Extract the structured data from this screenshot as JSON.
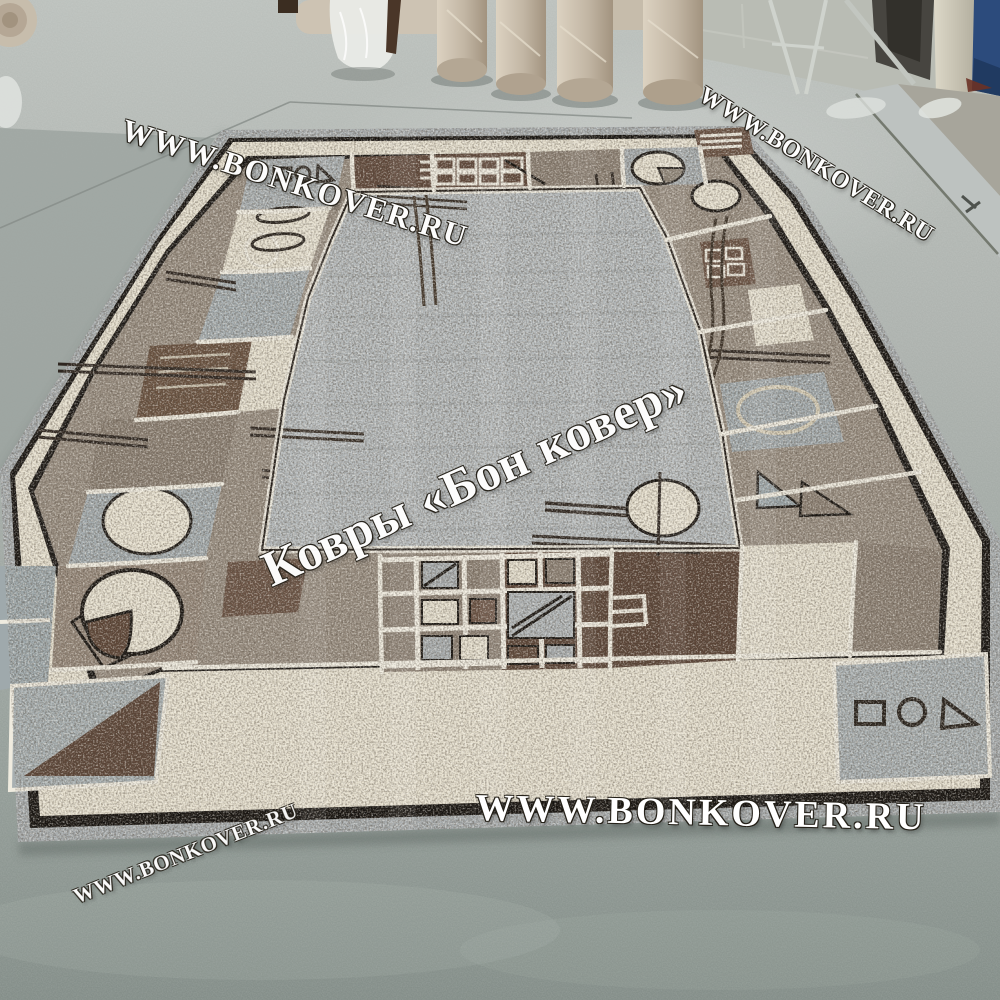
{
  "watermarks": {
    "top_left": "WWW.BONKOVER.RU",
    "top_right": "WWW.BONKOVER.RU",
    "center": "Ковры «Бон ковер»",
    "bottom_center": "WWW.BONKOVER.RU",
    "bottom_left": "WWW.BONKOVER.RU"
  },
  "scene": {
    "subject": "grey geometric bordered rug lying on painted concrete showroom floor",
    "background_objects": [
      "rolled-carpets-in-plastic",
      "plastic-wrap-bundle",
      "doorway-with-metal-ramp",
      "blue-door-panel",
      "metal-stand",
      "cream-pillar"
    ]
  },
  "palette": {
    "floor_top": "#b9beba",
    "floor_bottom": "#848e89",
    "rug_field_grey": "#b5babc",
    "rug_cream": "#e8e2d1",
    "rug_dark_brown": "#5a4335",
    "rug_taupe": "#948778",
    "rug_blue_grey": "#a2abae",
    "rug_outline_black": "#1a1613",
    "roll_beige": "#c9bfae",
    "door_blue": "#2c4b7c",
    "watermark": "#ffffff"
  }
}
